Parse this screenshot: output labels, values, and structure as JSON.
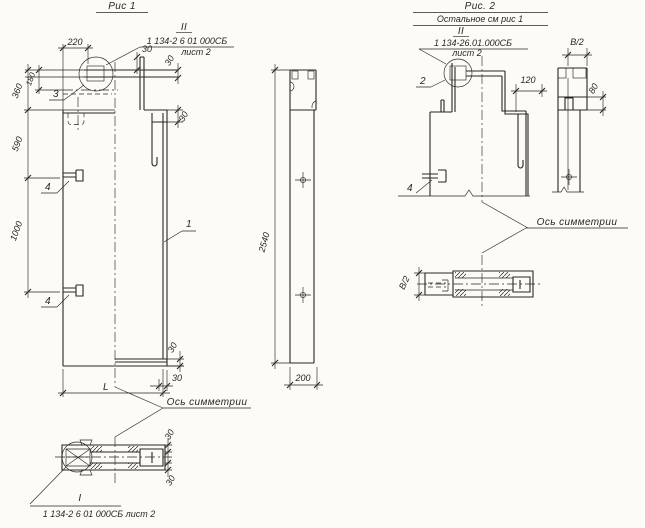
{
  "colors": {
    "paper": "#fcfbf7",
    "ink": "#2a2722"
  },
  "fig1": {
    "title": "Рис 1",
    "callout": {
      "mark": "II",
      "doc": "1 134-2 6 01 000СБ",
      "sheet": "лист 2"
    },
    "dims": {
      "d220": "220",
      "d30_plate": "30",
      "d30_bar": "30",
      "d30_step": "30",
      "d360": "360",
      "d180": "180",
      "d590": "590",
      "d1000": "1000",
      "d30_bottom_v": "30",
      "d30_bottom_h": "30",
      "dL": "L"
    },
    "marks": {
      "m1": "1",
      "m3": "3",
      "m4a": "4",
      "m4b": "4"
    },
    "axis_label": "Ось симметрии",
    "section": {
      "mark": "I",
      "doc": "1 134-2 6 01 000СБ лист 2",
      "d30_top": "30",
      "d30_bottom": "30"
    }
  },
  "side_view": {
    "d2540": "2540",
    "d200": "200"
  },
  "fig2": {
    "title": "Рис. 2",
    "subtitle": "Остальное см рис 1",
    "callout": {
      "mark": "II",
      "doc": "1 134-26.01.000СБ",
      "sheet": "лист 2"
    },
    "dims": {
      "d120": "120",
      "dB2_top": "В/2",
      "d80": "80",
      "dB2_section": "В/2"
    },
    "marks": {
      "m2": "2",
      "m4": "4"
    },
    "axis_label": "Ось симметрии"
  }
}
